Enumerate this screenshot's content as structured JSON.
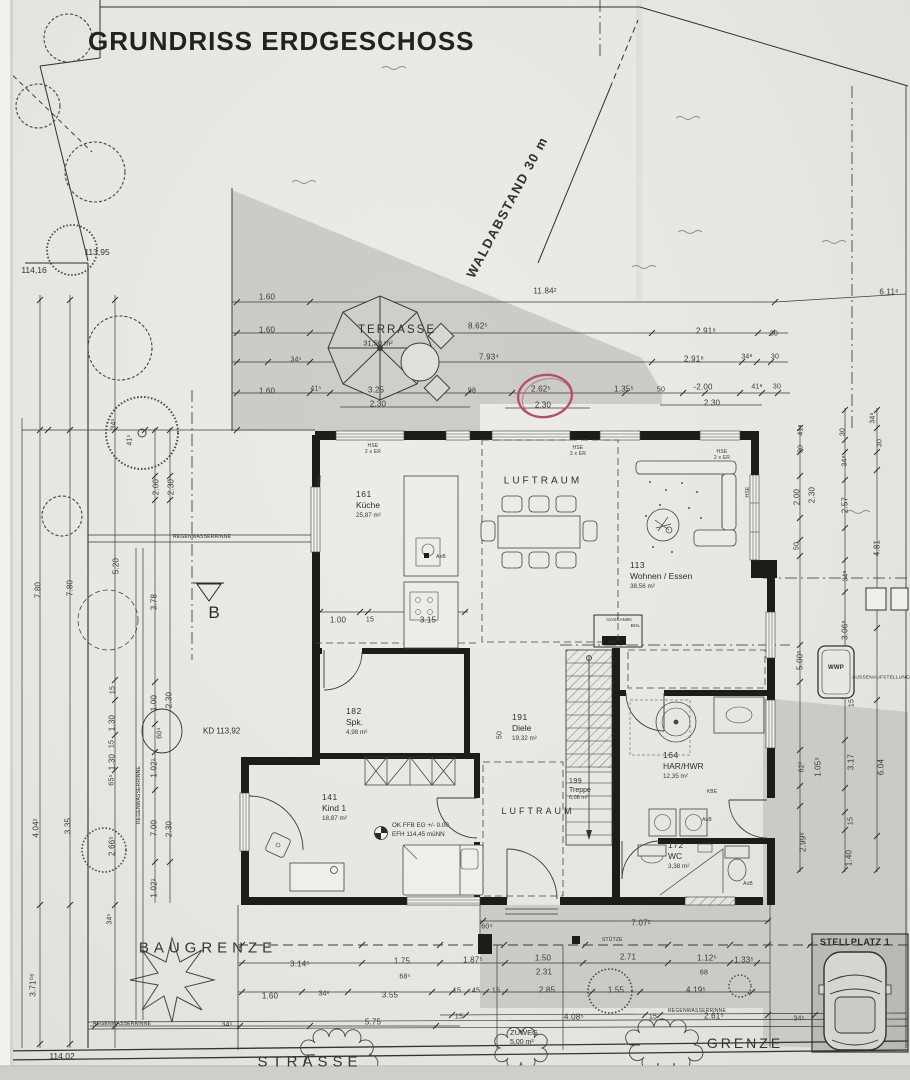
{
  "title": "GRUNDRISS ERDGESCHOSS",
  "colors": {
    "paper": "#e9e8e3",
    "ink": "#2d2c28",
    "shade": "#c8c7c3",
    "red_circle": "#b2506e"
  },
  "site": {
    "waldabstand": "WALDABSTAND 30 m",
    "baugrenze": "BAUGRENZE",
    "strasse": "STRASSE",
    "grenze": "GRENZE",
    "zuweg": "ZUWEG",
    "zuweg_area": "5,00 m²",
    "stellplatz": "STELLPLATZ 1",
    "stuetze": "STÜTZE",
    "section": "B",
    "kd": "KD 113,92",
    "h_left": "114,16",
    "h_tree": "113,95",
    "h_bottom": "114,02",
    "level1": "OK FFB EG +/- 0.00",
    "level2": "EFH 114,45 müNN",
    "wwp": "WWP",
    "wwp_note": "AUSSENAUFSTELLUNG",
    "gaskamin": "GASKAMIN",
    "gaskamin_sub": "BHL",
    "rinne": "REGENWASSERRINNE",
    "luftraum": "LUFTRAUM"
  },
  "terrace": {
    "name": "TERRASSE",
    "area": "31,50 m²"
  },
  "rooms": [
    {
      "num": "161",
      "name": "Küche",
      "area": "25,87 m²"
    },
    {
      "num": "113",
      "name": "Wohnen / Essen",
      "area": "38,56 m²"
    },
    {
      "num": "182",
      "name": "Spk.",
      "area": "4,98 m²"
    },
    {
      "num": "191",
      "name": "Diele",
      "area": "19,32 m²"
    },
    {
      "num": "141",
      "name": "Kind 1",
      "area": "18,87 m²"
    },
    {
      "num": "199",
      "name": "Treppe",
      "area": "6,08 m²"
    },
    {
      "num": "164",
      "name": "HAR/HWR",
      "area": "12,35 m²"
    },
    {
      "num": "172",
      "name": "WC",
      "area": "3,38 m²"
    }
  ],
  "dims": [
    {
      "t": "1.60",
      "x": 267,
      "y": 297
    },
    {
      "t": "11.84²",
      "x": 545,
      "y": 291
    },
    {
      "t": "6.11⁸",
      "x": 889,
      "y": 292
    },
    {
      "t": "1.60",
      "x": 267,
      "y": 330
    },
    {
      "t": "8.62⁵",
      "x": 478,
      "y": 326
    },
    {
      "t": "2.91⁸",
      "x": 706,
      "y": 331
    },
    {
      "t": "30",
      "x": 774,
      "y": 334,
      "s": 7
    },
    {
      "t": "34⁵",
      "x": 296,
      "y": 360,
      "s": 7
    },
    {
      "t": "7.93⁴",
      "x": 489,
      "y": 357
    },
    {
      "t": "2.91⁸",
      "x": 694,
      "y": 359
    },
    {
      "t": "34⁸",
      "x": 747,
      "y": 357,
      "s": 7
    },
    {
      "t": "30",
      "x": 775,
      "y": 357,
      "s": 7
    },
    {
      "t": "1.60",
      "x": 267,
      "y": 391
    },
    {
      "t": "41⁵",
      "x": 316,
      "y": 389,
      "s": 7
    },
    {
      "t": "3.25",
      "x": 376,
      "y": 390
    },
    {
      "t": "2.30",
      "x": 378,
      "y": 404
    },
    {
      "t": "98",
      "x": 472,
      "y": 391,
      "s": 7
    },
    {
      "t": "2.62⁵",
      "x": 541,
      "y": 389
    },
    {
      "t": "2.30",
      "x": 543,
      "y": 405
    },
    {
      "t": "1.35⁵",
      "x": 624,
      "y": 389
    },
    {
      "t": "50",
      "x": 661,
      "y": 390,
      "s": 7
    },
    {
      "t": "-2.00",
      "x": 703,
      "y": 387
    },
    {
      "t": "2.30",
      "x": 712,
      "y": 403
    },
    {
      "t": "41⁸",
      "x": 757,
      "y": 387,
      "s": 7
    },
    {
      "t": "30",
      "x": 777,
      "y": 387,
      "s": 7
    },
    {
      "t": "7.80",
      "x": 38,
      "y": 590,
      "r": -90
    },
    {
      "t": "7.80",
      "x": 70,
      "y": 588,
      "r": -90
    },
    {
      "t": "5.20",
      "x": 116,
      "y": 566,
      "r": -90
    },
    {
      "t": "3.78",
      "x": 154,
      "y": 602,
      "r": -90
    },
    {
      "t": "2.00",
      "x": 156,
      "y": 487,
      "r": -90
    },
    {
      "t": "2.30",
      "x": 171,
      "y": 487,
      "r": -90
    },
    {
      "t": "34⁵",
      "x": 114,
      "y": 424,
      "r": -90,
      "s": 7
    },
    {
      "t": "41⁵",
      "x": 130,
      "y": 440,
      "r": -90,
      "s": 7
    },
    {
      "t": "15",
      "x": 113,
      "y": 690,
      "r": -90,
      "s": 7
    },
    {
      "t": "1.00",
      "x": 154,
      "y": 703,
      "r": -90
    },
    {
      "t": "2.30",
      "x": 169,
      "y": 700,
      "r": -90
    },
    {
      "t": "1.30",
      "x": 112,
      "y": 723,
      "r": -90
    },
    {
      "t": "60⁴",
      "x": 160,
      "y": 733,
      "r": -90,
      "s": 7
    },
    {
      "t": "15",
      "x": 112,
      "y": 744,
      "r": -90,
      "s": 7
    },
    {
      "t": "1.30",
      "x": 112,
      "y": 762,
      "r": -90
    },
    {
      "t": "65⁵",
      "x": 112,
      "y": 780,
      "r": -90,
      "s": 7
    },
    {
      "t": "1.02¹",
      "x": 154,
      "y": 768,
      "r": -90
    },
    {
      "t": "7.00",
      "x": 154,
      "y": 828,
      "r": -90
    },
    {
      "t": "2.30",
      "x": 169,
      "y": 829,
      "r": -90
    },
    {
      "t": "2.66⁵",
      "x": 112,
      "y": 846,
      "r": -90
    },
    {
      "t": "1.02¹",
      "x": 154,
      "y": 888,
      "r": -90
    },
    {
      "t": "34⁵",
      "x": 110,
      "y": 919,
      "r": -90,
      "s": 7
    },
    {
      "t": "4.04²",
      "x": 36,
      "y": 828,
      "r": -90
    },
    {
      "t": "3.35",
      "x": 68,
      "y": 826,
      "r": -90
    },
    {
      "t": "3.71⁰⁸",
      "x": 33,
      "y": 985,
      "r": -90
    },
    {
      "t": "41⁸",
      "x": 801,
      "y": 430,
      "r": -90,
      "s": 7
    },
    {
      "t": "30",
      "x": 801,
      "y": 449,
      "r": -90,
      "s": 7
    },
    {
      "t": "30",
      "x": 843,
      "y": 432,
      "r": -90,
      "s": 7
    },
    {
      "t": "34⁸",
      "x": 845,
      "y": 461,
      "r": -90,
      "s": 7
    },
    {
      "t": "34⁸",
      "x": 873,
      "y": 418,
      "r": -90,
      "s": 7
    },
    {
      "t": "30",
      "x": 880,
      "y": 443,
      "r": -90,
      "s": 7
    },
    {
      "t": "2.00",
      "x": 797,
      "y": 497,
      "r": -90
    },
    {
      "t": "2.30",
      "x": 812,
      "y": 495,
      "r": -90
    },
    {
      "t": "2.57",
      "x": 845,
      "y": 505,
      "r": -90
    },
    {
      "t": "50",
      "x": 797,
      "y": 546,
      "r": -90,
      "s": 7
    },
    {
      "t": "4.81",
      "x": 877,
      "y": 548,
      "r": -90
    },
    {
      "t": "34⁸",
      "x": 846,
      "y": 576,
      "r": -90,
      "s": 7
    },
    {
      "t": "3.06⁸",
      "x": 845,
      "y": 630,
      "r": -90
    },
    {
      "t": "5.00⁵",
      "x": 800,
      "y": 660,
      "r": -90
    },
    {
      "t": "15",
      "x": 852,
      "y": 703,
      "r": -90,
      "s": 7
    },
    {
      "t": "62³",
      "x": 802,
      "y": 767,
      "r": -90,
      "s": 7
    },
    {
      "t": "1.05⁹",
      "x": 818,
      "y": 767,
      "r": -90
    },
    {
      "t": "3.17",
      "x": 851,
      "y": 762,
      "r": -90
    },
    {
      "t": "6.04",
      "x": 881,
      "y": 767,
      "r": -90
    },
    {
      "t": "15",
      "x": 851,
      "y": 821,
      "r": -90,
      "s": 7
    },
    {
      "t": "2.99⁸",
      "x": 803,
      "y": 842,
      "r": -90
    },
    {
      "t": "1.40",
      "x": 849,
      "y": 858,
      "r": -90
    },
    {
      "t": "1.00",
      "x": 338,
      "y": 620
    },
    {
      "t": "15",
      "x": 370,
      "y": 620,
      "s": 7
    },
    {
      "t": "3.15",
      "x": 428,
      "y": 620
    },
    {
      "t": "50",
      "x": 500,
      "y": 735,
      "r": -90,
      "s": 7
    },
    {
      "t": "3.14⁵",
      "x": 300,
      "y": 964
    },
    {
      "t": "1.75",
      "x": 402,
      "y": 961
    },
    {
      "t": "68⁵",
      "x": 405,
      "y": 977,
      "s": 7
    },
    {
      "t": "1.87⁵",
      "x": 473,
      "y": 960
    },
    {
      "t": "1.50",
      "x": 543,
      "y": 958
    },
    {
      "t": "2.71",
      "x": 628,
      "y": 957
    },
    {
      "t": "1.12⁵",
      "x": 707,
      "y": 958
    },
    {
      "t": "1.33⁵",
      "x": 744,
      "y": 960
    },
    {
      "t": "2.31",
      "x": 544,
      "y": 972
    },
    {
      "t": "68",
      "x": 704,
      "y": 973,
      "s": 7
    },
    {
      "t": "1.60",
      "x": 270,
      "y": 996
    },
    {
      "t": "34⁶",
      "x": 324,
      "y": 994,
      "s": 7
    },
    {
      "t": "3.55",
      "x": 390,
      "y": 995
    },
    {
      "t": "15",
      "x": 457,
      "y": 991,
      "s": 7
    },
    {
      "t": "45",
      "x": 476,
      "y": 991,
      "s": 7
    },
    {
      "t": "15",
      "x": 496,
      "y": 991,
      "s": 7
    },
    {
      "t": "2.85",
      "x": 547,
      "y": 990
    },
    {
      "t": "1.55",
      "x": 616,
      "y": 990
    },
    {
      "t": "4.19⁵",
      "x": 696,
      "y": 990
    },
    {
      "t": "34⁵",
      "x": 227,
      "y": 1025,
      "s": 7
    },
    {
      "t": "5.75",
      "x": 373,
      "y": 1022
    },
    {
      "t": "15",
      "x": 459,
      "y": 1017,
      "s": 7
    },
    {
      "t": "4.08⁵",
      "x": 574,
      "y": 1017
    },
    {
      "t": "15",
      "x": 653,
      "y": 1017,
      "s": 7
    },
    {
      "t": "2.61⁵",
      "x": 714,
      "y": 1016
    },
    {
      "t": "34⁵",
      "x": 799,
      "y": 1019,
      "s": 7
    },
    {
      "t": "7.07²",
      "x": 641,
      "y": 923
    },
    {
      "t": "60⁴",
      "x": 487,
      "y": 927,
      "s": 7
    },
    {
      "t": "HSE",
      "x": 373,
      "y": 446,
      "s": 5
    },
    {
      "t": "2 x ER",
      "x": 373,
      "y": 452,
      "s": 5
    },
    {
      "t": "HSE",
      "x": 578,
      "y": 448,
      "s": 5
    },
    {
      "t": "3 x ER",
      "x": 578,
      "y": 454,
      "s": 5
    },
    {
      "t": "HSE",
      "x": 722,
      "y": 452,
      "s": 5
    },
    {
      "t": "2 x ER",
      "x": 722,
      "y": 458,
      "s": 5
    },
    {
      "t": "HSE",
      "x": 320,
      "y": 480,
      "r": -90,
      "s": 5
    },
    {
      "t": "HSE",
      "x": 748,
      "y": 492,
      "r": -90,
      "s": 5
    },
    {
      "t": "AsB",
      "x": 441,
      "y": 557,
      "s": 5
    },
    {
      "t": "AsB",
      "x": 707,
      "y": 820,
      "s": 5
    },
    {
      "t": "AsB",
      "x": 748,
      "y": 884,
      "s": 5
    },
    {
      "t": "KBE",
      "x": 712,
      "y": 792,
      "s": 5
    }
  ]
}
